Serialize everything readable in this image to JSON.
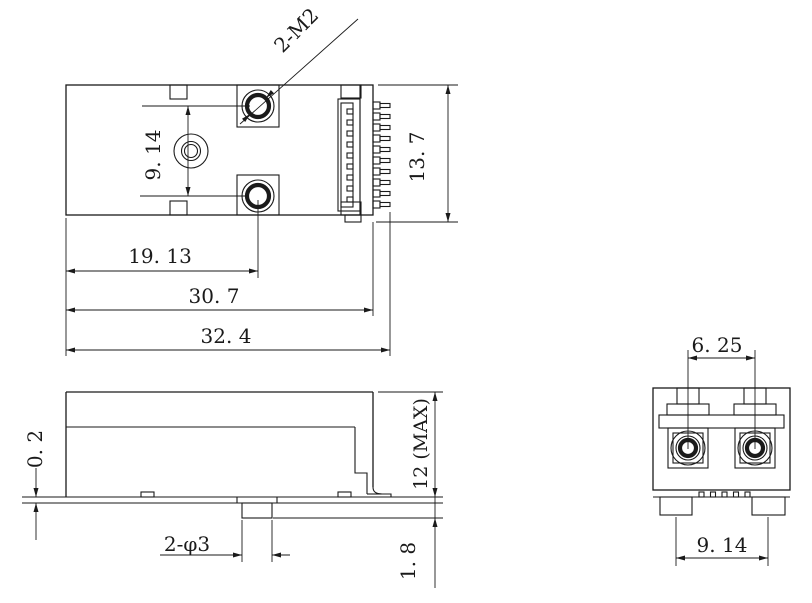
{
  "meta": {
    "drawing_type": "mechanical part drawing, three views",
    "background": "#ffffff",
    "line_color": "#1a1a1a"
  },
  "top_view": {
    "labels": {
      "hole_pitch": "9. 14",
      "thread_callout": "2-M2",
      "width": "13. 7",
      "hole_offset": "19. 13",
      "body_length": "30. 7",
      "overall_length": "32. 4"
    }
  },
  "side_view": {
    "labels": {
      "base_thickness": "0. 2",
      "max_height": "12 (MAX)",
      "peg_callout": "2-φ3",
      "peg_height": "1. 8"
    }
  },
  "end_view": {
    "labels": {
      "port_pitch": "6. 25",
      "foot_pitch": "9. 14"
    }
  }
}
